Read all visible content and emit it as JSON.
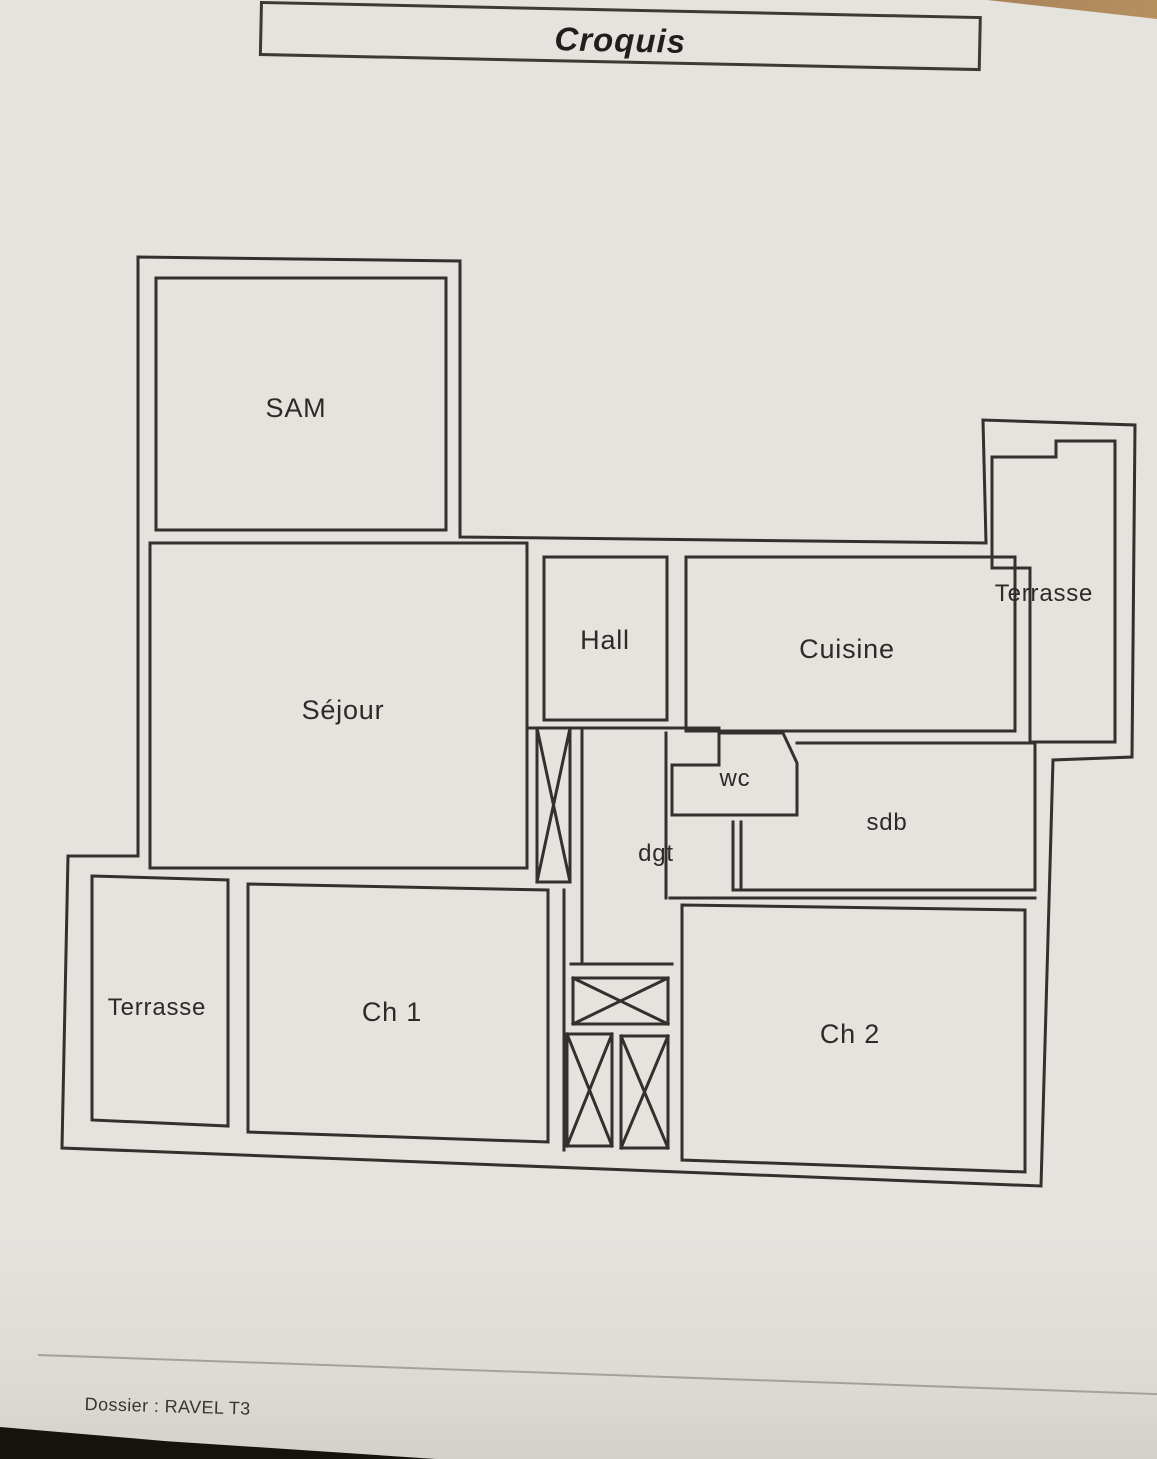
{
  "header": {
    "title": "Croquis"
  },
  "floor_plan": {
    "wall_color": "#33312d",
    "paper_color": "#e5e3de",
    "rooms": [
      {
        "id": "sam",
        "label": "SAM"
      },
      {
        "id": "sejour",
        "label": "Séjour"
      },
      {
        "id": "hall",
        "label": "Hall"
      },
      {
        "id": "cuisine",
        "label": "Cuisine"
      },
      {
        "id": "terrasse-top",
        "label": "Terrasse"
      },
      {
        "id": "wc",
        "label": "wc"
      },
      {
        "id": "sdb",
        "label": "sdb"
      },
      {
        "id": "dgt",
        "label": "dgt"
      },
      {
        "id": "terrasse-bottom",
        "label": "Terrasse"
      },
      {
        "id": "ch1",
        "label": "Ch 1"
      },
      {
        "id": "ch2",
        "label": "Ch 2"
      }
    ]
  },
  "footer": {
    "dossier": "Dossier : RAVEL T3"
  }
}
